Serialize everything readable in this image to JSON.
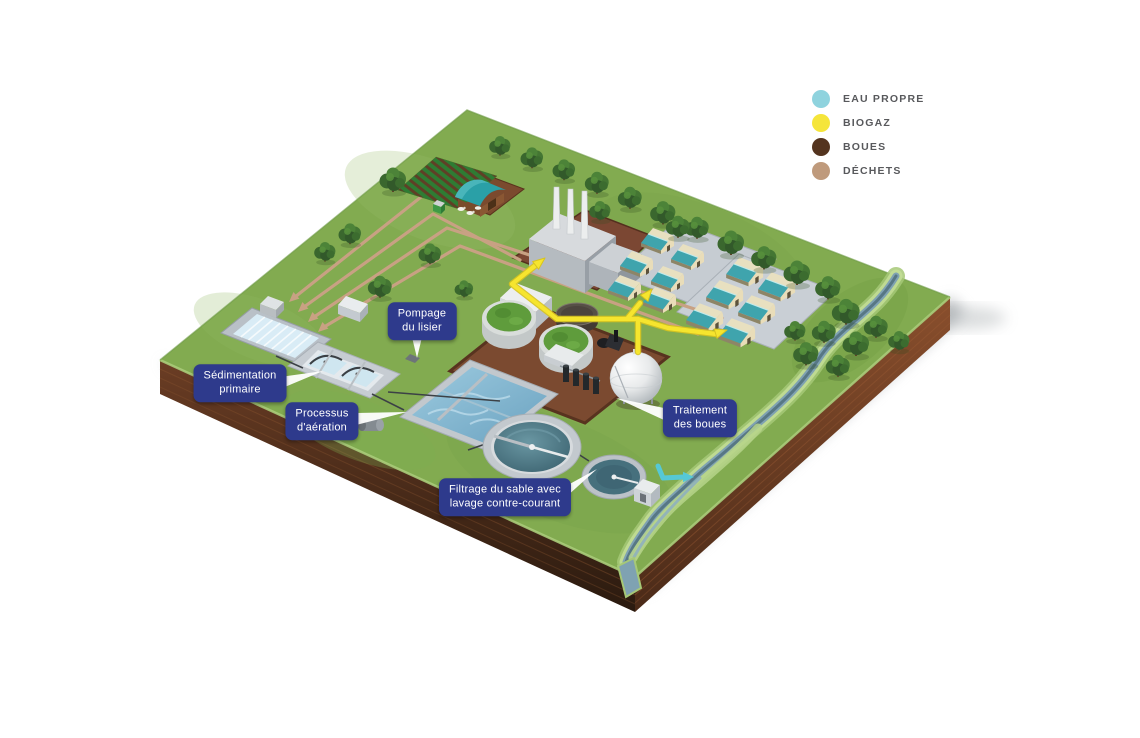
{
  "legend": {
    "items": [
      {
        "key": "eau_propre",
        "label": "EAU PROPRE"
      },
      {
        "key": "biogaz",
        "label": "BIOGAZ"
      },
      {
        "key": "boues",
        "label": "BOUES"
      },
      {
        "key": "dechets",
        "label": "DÉCHETS"
      }
    ]
  },
  "callouts": {
    "pompage": "Pompage\ndu lisier",
    "sedimentation": "Sédimentation\nprimaire",
    "aeration": "Processus\nd'aération",
    "boues": "Traitement\ndes boues",
    "filtrage": "Filtrage du sable avec\nlavage contre-courant"
  },
  "colors": {
    "eau_propre": "#8fd3de",
    "biogaz": "#f5e53a",
    "boues": "#54341f",
    "dechets": "#bf9a7c",
    "flow_eau": "#56c8d6",
    "flow_biogaz": "#f6e52e",
    "flow_dechets": "#c8a183",
    "badge_bg": "#2e3a8c",
    "legend_text": "#58595c"
  }
}
